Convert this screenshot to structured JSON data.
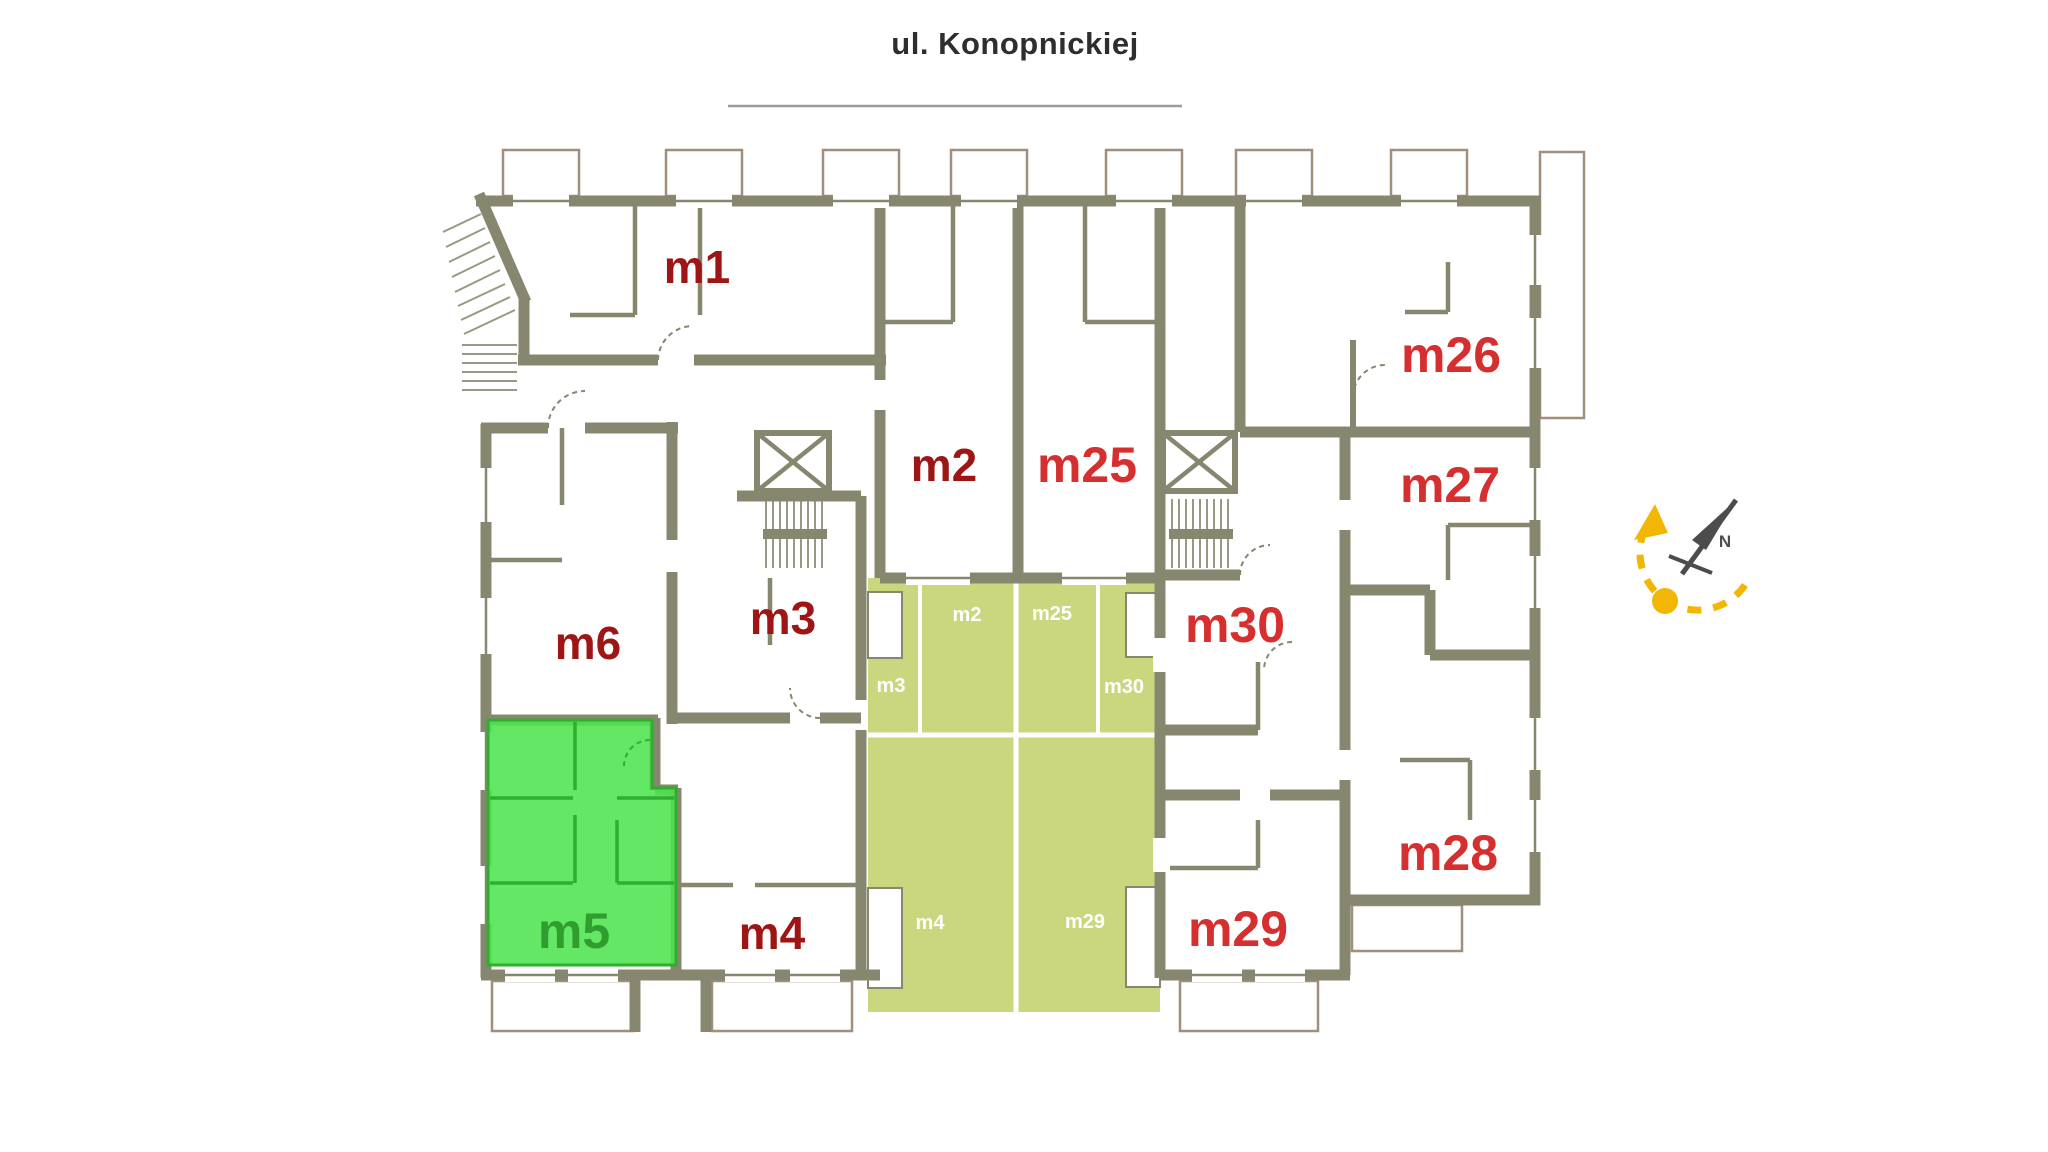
{
  "street": {
    "name": "ul. Konopnickiej"
  },
  "highlighted_unit": "m5",
  "units": {
    "m1": {
      "label": "m1",
      "style": "dark",
      "highlighted": false
    },
    "m2": {
      "label": "m2",
      "style": "dark",
      "highlighted": false
    },
    "m3": {
      "label": "m3",
      "style": "dark",
      "highlighted": false
    },
    "m4": {
      "label": "m4",
      "style": "dark",
      "highlighted": false
    },
    "m5": {
      "label": "m5",
      "style": "highlight",
      "highlighted": true
    },
    "m6": {
      "label": "m6",
      "style": "dark",
      "highlighted": false
    },
    "m25": {
      "label": "m25",
      "style": "bright",
      "highlighted": false
    },
    "m26": {
      "label": "m26",
      "style": "bright",
      "highlighted": false
    },
    "m27": {
      "label": "m27",
      "style": "bright",
      "highlighted": false
    },
    "m28": {
      "label": "m28",
      "style": "bright",
      "highlighted": false
    },
    "m29": {
      "label": "m29",
      "style": "bright",
      "highlighted": false
    },
    "m30": {
      "label": "m30",
      "style": "bright",
      "highlighted": false
    }
  },
  "garden_plots": {
    "m2": {
      "label": "m2"
    },
    "m25": {
      "label": "m25"
    },
    "m3": {
      "label": "m3"
    },
    "m30": {
      "label": "m30"
    },
    "m4": {
      "label": "m4"
    },
    "m29": {
      "label": "m29"
    }
  },
  "compass": {
    "north_label": "N"
  },
  "colors": {
    "wall": "#87876f",
    "balcony_outline": "#a18e7d",
    "unit_label_dark": "#9e1515",
    "unit_label_bright": "#d62f2f",
    "garden_fill": "#cbd77f",
    "garden_label": "#ffffff",
    "highlight_fill": "#4fe44f",
    "highlight_stroke": "#2fae2f",
    "highlight_label": "#2f9e2f",
    "title_text": "#2e2e2e",
    "title_underline": "#9b9b9b",
    "compass_arc": "#f2b705",
    "compass_needle": "#4c4c4c"
  }
}
